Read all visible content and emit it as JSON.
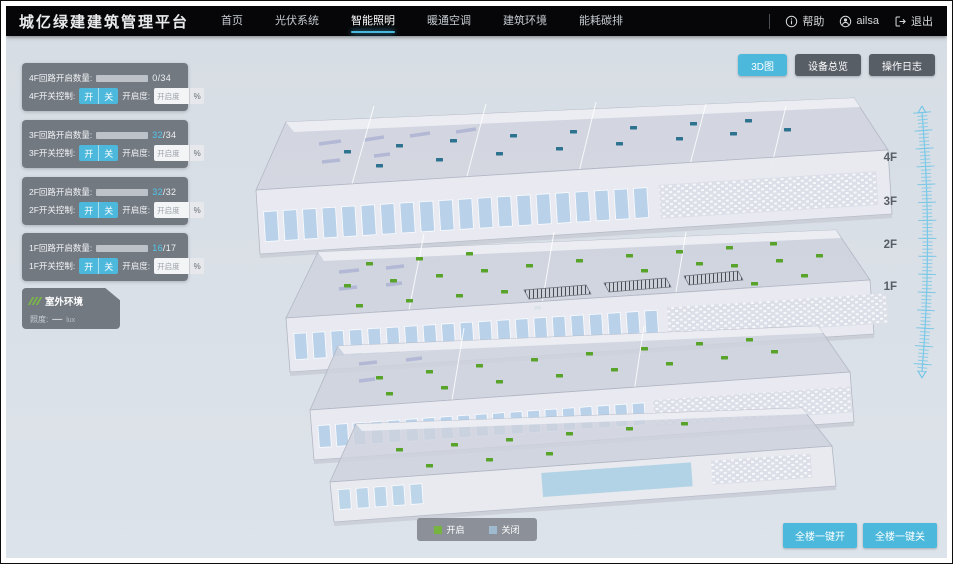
{
  "header": {
    "title": "城亿绿建建筑管理平台",
    "nav": [
      {
        "label": "首页"
      },
      {
        "label": "光伏系统"
      },
      {
        "label": "智能照明"
      },
      {
        "label": "暖通空调"
      },
      {
        "label": "建筑环境"
      },
      {
        "label": "能耗碳排"
      }
    ],
    "help_label": "帮助",
    "username": "ailsa",
    "logout_label": "退出"
  },
  "toolbar": {
    "buttons": [
      {
        "label": "3D图"
      },
      {
        "label": "设备总览"
      },
      {
        "label": "操作日志"
      }
    ]
  },
  "floor_panels": [
    {
      "count_label": "4F回路开启数量:",
      "current": "0",
      "total": "/34",
      "bar_style": "width:0%",
      "switch_label": "4F开关控制:",
      "on_label": "开",
      "off_label": "关",
      "openness_label": "开启度:",
      "openness_placeholder": "开启度",
      "percent_label": "%"
    },
    {
      "count_label": "3F回路开启数量:",
      "current": "32",
      "total": "/34",
      "bar_style": "width:94%",
      "switch_label": "3F开关控制:",
      "on_label": "开",
      "off_label": "关",
      "openness_label": "开启度:",
      "openness_placeholder": "开启度",
      "percent_label": "%"
    },
    {
      "count_label": "2F回路开启数量:",
      "current": "32",
      "total": "/32",
      "bar_style": "width:100%",
      "switch_label": "2F开关控制:",
      "on_label": "开",
      "off_label": "关",
      "openness_label": "开启度:",
      "openness_placeholder": "开启度",
      "percent_label": "%"
    },
    {
      "count_label": "1F回路开启数量:",
      "current": "16",
      "total": "/17",
      "bar_style": "width:94%",
      "switch_label": "1F开关控制:",
      "on_label": "开",
      "off_label": "关",
      "openness_label": "开启度:",
      "openness_placeholder": "开启度",
      "percent_label": "%"
    }
  ],
  "outdoor": {
    "title": "室外环境",
    "metric_label": "照度:",
    "metric_value": "—",
    "metric_unit": "lux"
  },
  "floor_labels": [
    "4F",
    "3F",
    "2F",
    "1F"
  ],
  "legend": {
    "on_label": "开启",
    "off_label": "关闭",
    "on_color": "#76b43f",
    "off_color": "#9fb9cf"
  },
  "bottom_buttons": {
    "all_on": "全楼一键开",
    "all_off": "全楼一键关"
  },
  "colors": {
    "accent": "#4cb9dc",
    "header_bg": "#060608",
    "canvas_bg": "#dce2e9",
    "panel_bg": "rgba(86,92,100,0.78)"
  }
}
